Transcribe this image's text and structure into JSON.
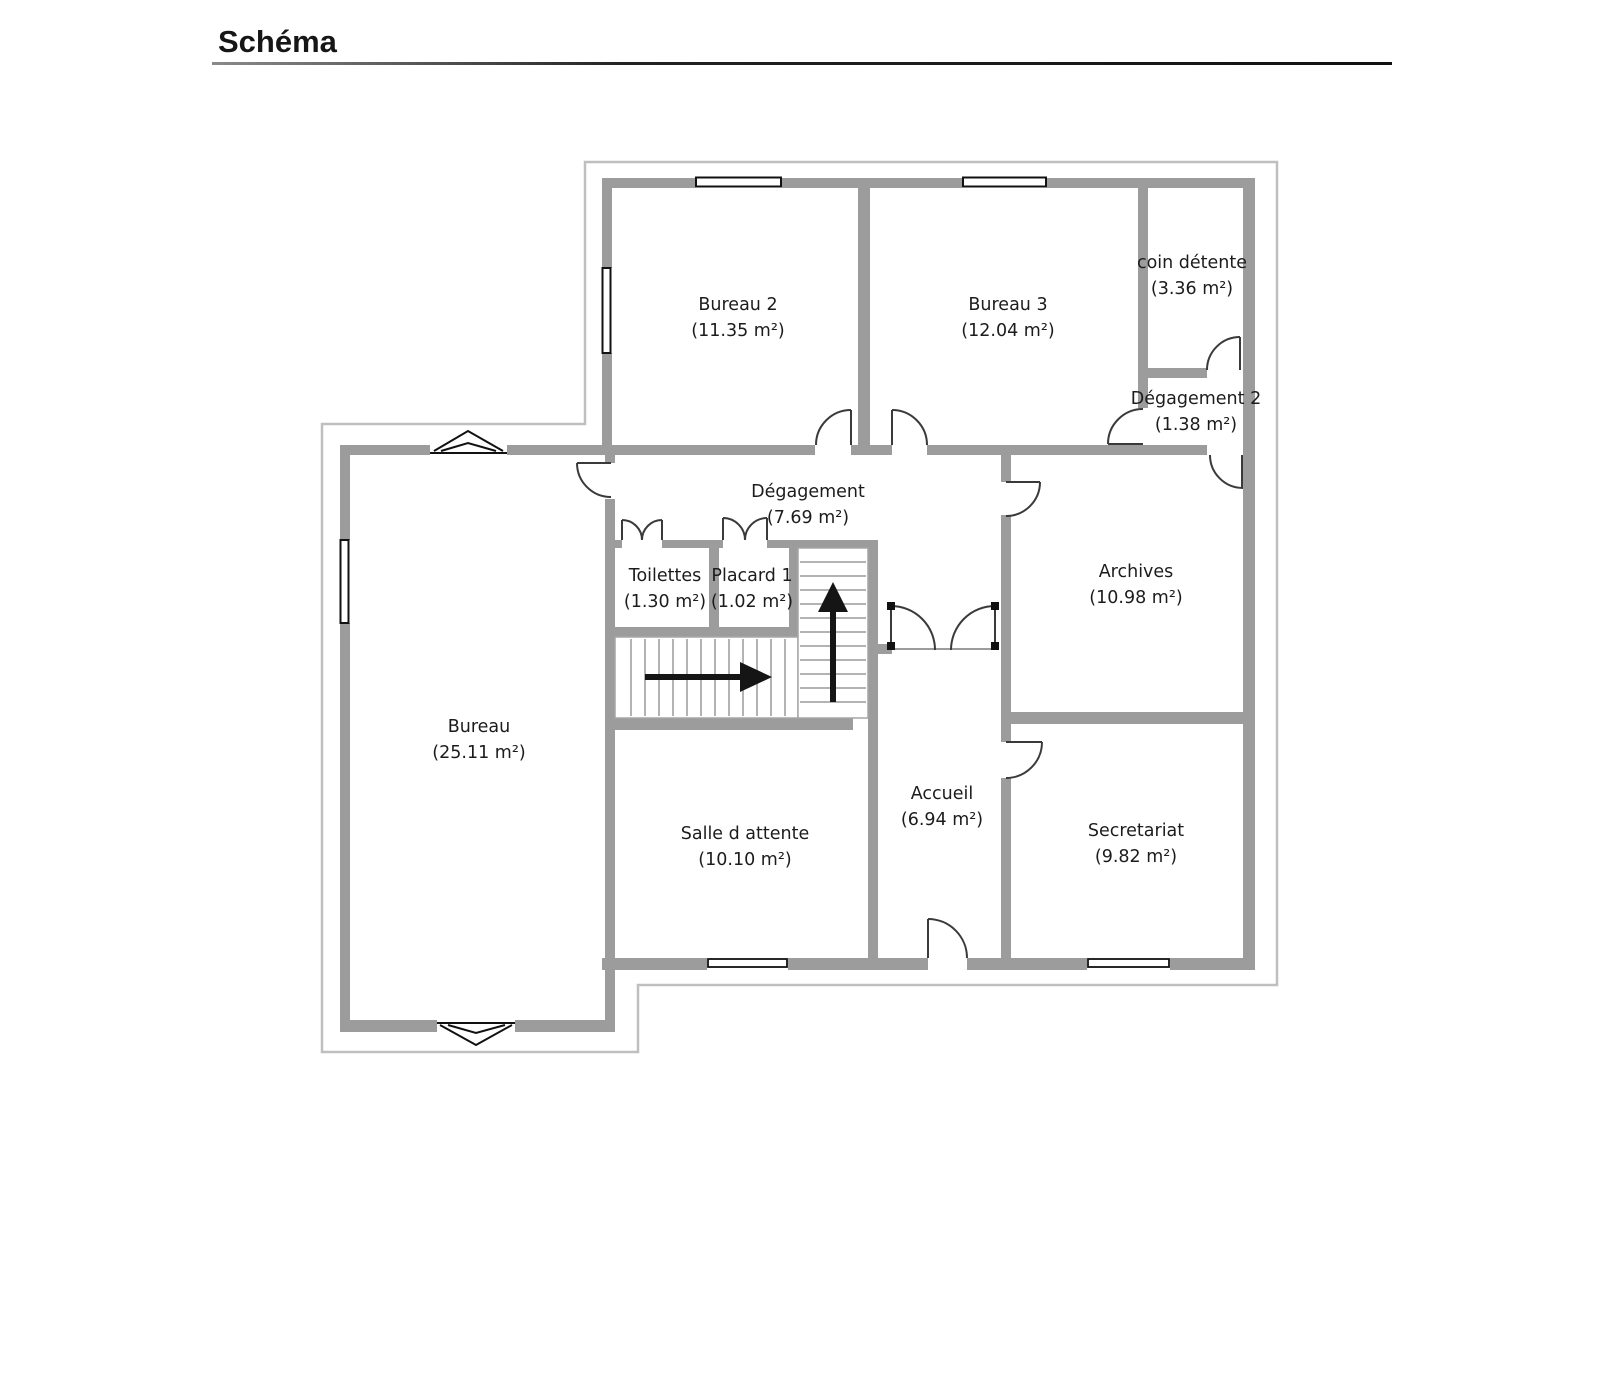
{
  "title": "Schéma",
  "plan": {
    "rooms": [
      {
        "id": "bureau-2",
        "name": "Bureau 2",
        "area": "(11.35 m²)"
      },
      {
        "id": "bureau-3",
        "name": "Bureau 3",
        "area": "(12.04 m²)"
      },
      {
        "id": "coin-detente",
        "name": "coin détente",
        "area": "(3.36 m²)"
      },
      {
        "id": "degagement-2",
        "name": "Dégagement 2",
        "area": "(1.38 m²)"
      },
      {
        "id": "degagement",
        "name": "Dégagement",
        "area": "(7.69 m²)"
      },
      {
        "id": "toilettes",
        "name": "Toilettes",
        "area": "(1.30 m²)"
      },
      {
        "id": "placard-1",
        "name": "Placard 1",
        "area": "(1.02 m²)"
      },
      {
        "id": "archives",
        "name": "Archives",
        "area": "(10.98 m²)"
      },
      {
        "id": "bureau",
        "name": "Bureau",
        "area": "(25.11 m²)"
      },
      {
        "id": "salle-d-attente",
        "name": "Salle d attente",
        "area": "(10.10 m²)"
      },
      {
        "id": "accueil",
        "name": "Accueil",
        "area": "(6.94 m²)"
      },
      {
        "id": "secretariat",
        "name": "Secretariat",
        "area": "(9.82 m²)"
      }
    ],
    "icons": {
      "up_arrow": "stairs-up-direction",
      "right_arrow": "stairs-right-direction"
    },
    "colors": {
      "wall": "#9c9c9c",
      "outline": "#bfbfbf",
      "ink": "#1c1c1c",
      "arrow": "#151515"
    }
  }
}
